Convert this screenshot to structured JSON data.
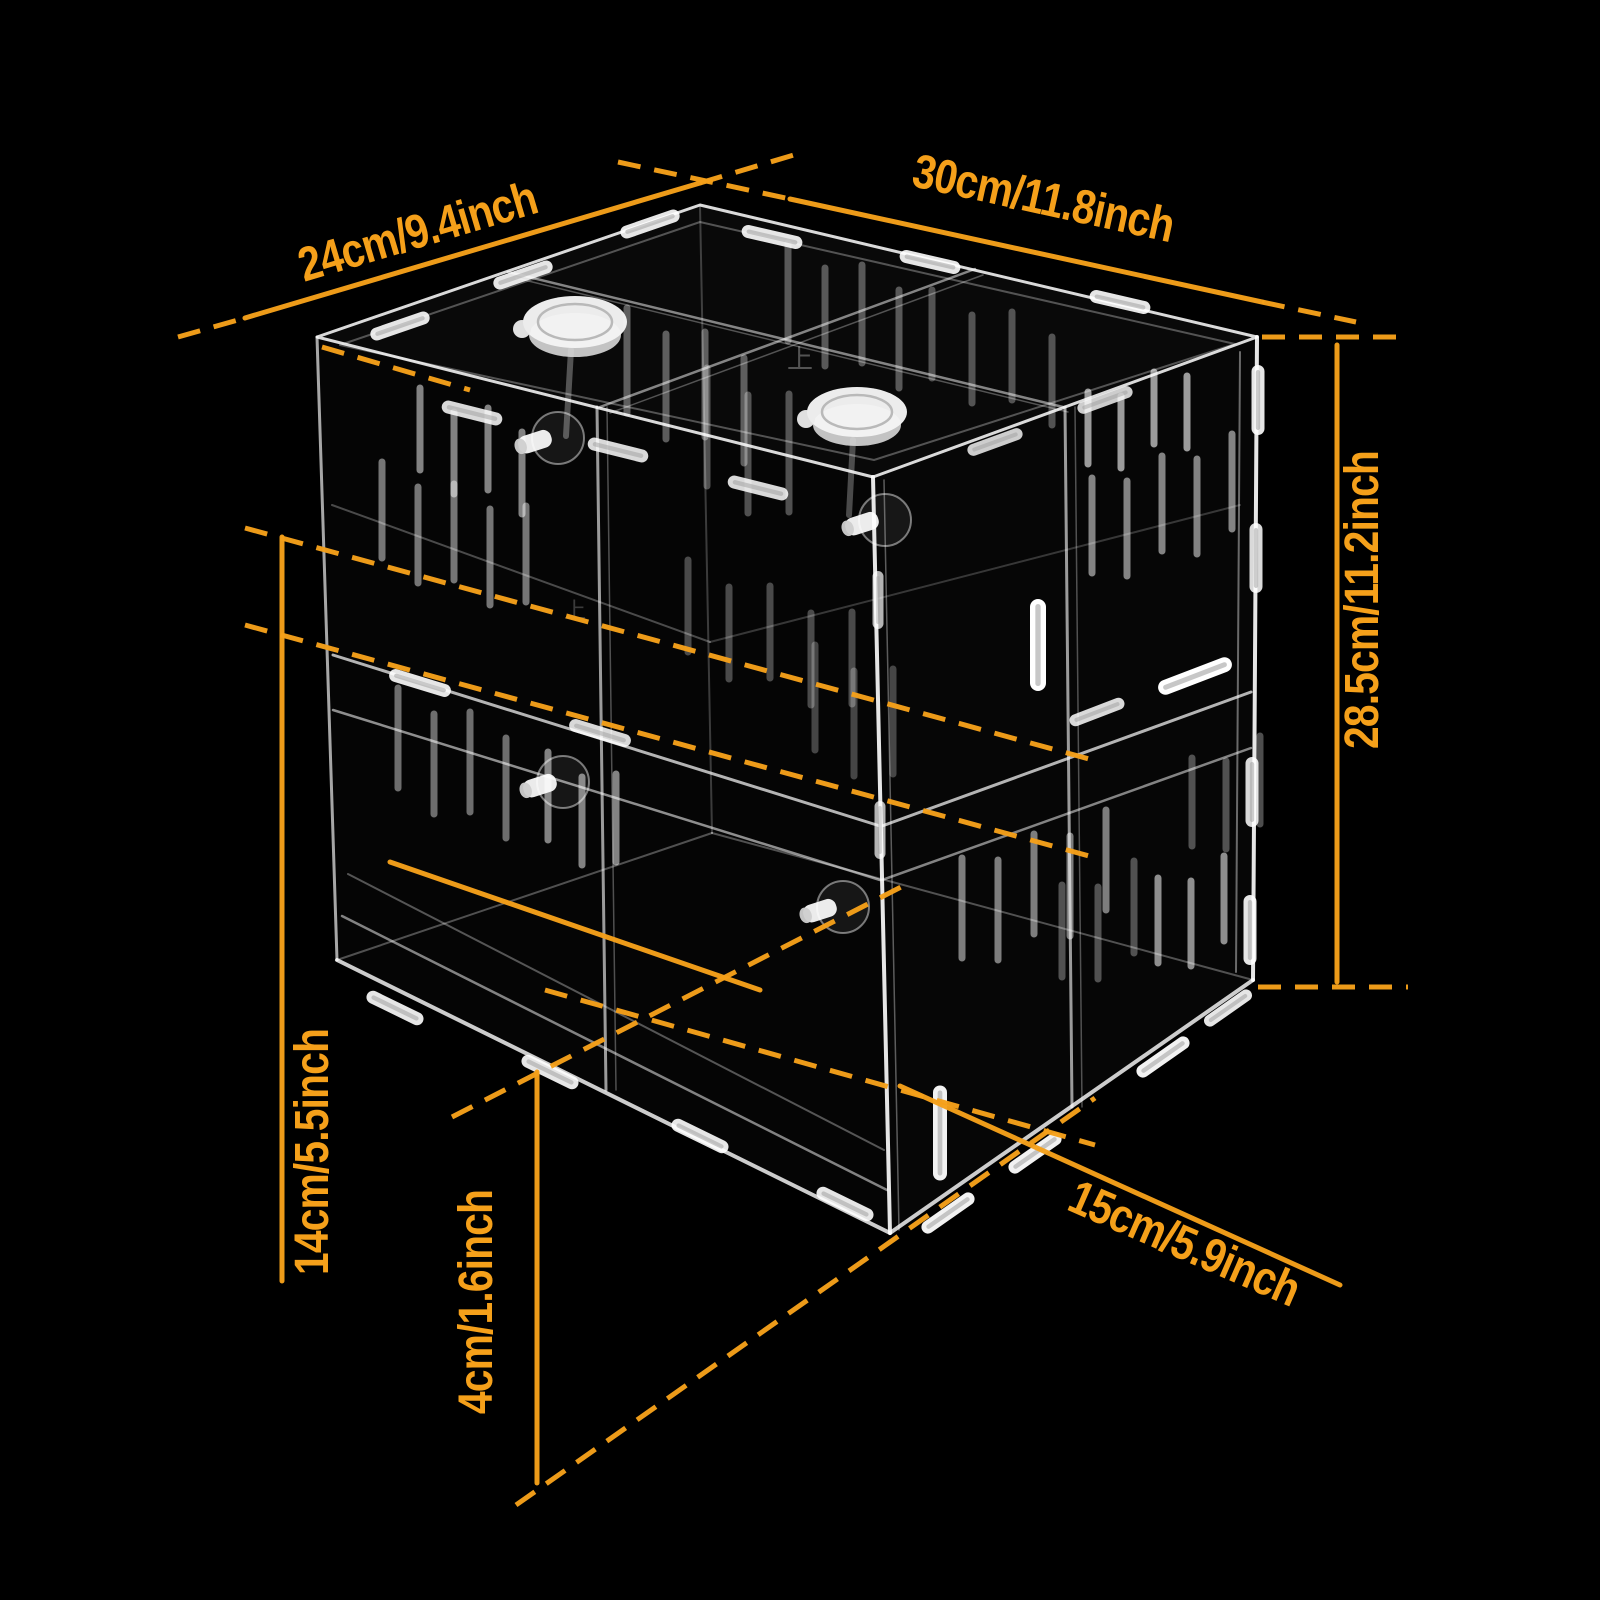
{
  "canvas": {
    "width": 1600,
    "height": 1600,
    "background": "#000000"
  },
  "colors": {
    "accent": "#F5A01A",
    "wire": "#FFFFFF"
  },
  "labels": {
    "depth": {
      "text": "24cm/9.4inch"
    },
    "width": {
      "text": "30cm/11.8inch"
    },
    "height": {
      "text": "28.5cm/11.2inch"
    },
    "compartment_height": {
      "text": "14cm/5.5inch"
    },
    "tray_height": {
      "text": "4cm/1.6inch"
    },
    "compartment_width": {
      "text": "15cm/5.9inch"
    }
  },
  "dimensions": [
    {
      "id": "depth",
      "bind": "labels.depth.text",
      "x": 422,
      "y": 247,
      "angle": -16.5,
      "fontSize": 48,
      "solid": [
        245,
        318,
        700,
        183
      ],
      "dashes": [
        [
          178,
          337,
          245,
          318
        ],
        [
          700,
          183,
          797,
          154
        ]
      ]
    },
    {
      "id": "width",
      "bind": "labels.width.text",
      "x": 1040,
      "y": 214,
      "angle": 12.3,
      "fontSize": 48,
      "solid": [
        790,
        199,
        1262,
        302
      ],
      "dashes": [
        [
          618,
          162,
          790,
          199
        ],
        [
          1262,
          302,
          1356,
          322
        ]
      ]
    },
    {
      "id": "height",
      "bind": "labels.height.text",
      "x": 1378,
      "y": 600,
      "angle": -90,
      "fontSize": 48,
      "solid": [
        1337,
        345,
        1337,
        982
      ],
      "dashes": [
        [
          1262,
          337,
          1408,
          337
        ],
        [
          1258,
          987,
          1408,
          987
        ]
      ]
    },
    {
      "id": "compartment_height",
      "bind": "labels.compartment_height.text",
      "x": 328,
      "y": 1152,
      "angle": -90,
      "fontSize": 48,
      "solid": [
        282,
        537,
        282,
        1281
      ],
      "dashes": []
    },
    {
      "id": "tray_height",
      "bind": "labels.tray_height.text",
      "x": 492,
      "y": 1302,
      "angle": -90,
      "fontSize": 48,
      "solid": [
        537,
        1072,
        537,
        1483
      ],
      "dashes": []
    },
    {
      "id": "compartment_width",
      "bind": "labels.compartment_width.text",
      "x": 1178,
      "y": 1258,
      "angle": 23.5,
      "fontSize": 48,
      "solid": [
        900,
        1086,
        1340,
        1285
      ],
      "dashes": []
    }
  ],
  "figure": {
    "aux_solid_lines": [
      [
        390,
        862,
        760,
        990
      ]
    ],
    "aux_dashed_lines": [
      [
        245,
        528,
        1100,
        762
      ],
      [
        245,
        625,
        1100,
        859
      ],
      [
        452,
        1117,
        903,
        886
      ],
      [
        516,
        1505,
        1095,
        1098
      ],
      [
        545,
        990,
        1095,
        1145
      ],
      [
        322,
        347,
        470,
        390
      ]
    ],
    "box": {
      "faces": [
        {
          "d": "M317,337 L700,205 L1257,337 L873,477 Z",
          "fill": "rgba(255,255,255,0.035)"
        },
        {
          "d": "M317,337 L873,477 L890,1233 L337,960 Z",
          "fill": "rgba(255,255,255,0.018)"
        },
        {
          "d": "M873,477 L1257,337 L1253,980 L890,1233 Z",
          "fill": "rgba(255,255,255,0.022)"
        }
      ],
      "paths": [
        {
          "d": "M317,337 L700,205 L1257,337 L873,477 Z",
          "w": 3,
          "o": 0.85
        },
        {
          "d": "M340,345 L700,222 L1235,344 L874,460 Z",
          "w": 2,
          "o": 0.3
        }
      ],
      "edges": [
        [
          317,
          337,
          337,
          960,
          3,
          0.65
        ],
        [
          873,
          477,
          890,
          1233,
          4,
          0.9
        ],
        [
          884,
          480,
          899,
          1230,
          1.5,
          0.35
        ],
        [
          1257,
          337,
          1253,
          980,
          4,
          0.9
        ],
        [
          1240,
          352,
          1236,
          972,
          2,
          0.4
        ],
        [
          337,
          960,
          890,
          1233,
          4,
          0.8
        ],
        [
          890,
          1233,
          1253,
          980,
          4,
          0.8
        ],
        [
          342,
          916,
          887,
          1190,
          2.5,
          0.5
        ],
        [
          348,
          874,
          884,
          1150,
          2,
          0.32
        ],
        [
          337,
          960,
          712,
          833,
          2,
          0.3
        ],
        [
          712,
          833,
          1253,
          980,
          2,
          0.3
        ],
        [
          700,
          205,
          712,
          833,
          2,
          0.22
        ],
        [
          333,
          655,
          880,
          826,
          3,
          0.7
        ],
        [
          333,
          710,
          880,
          880,
          2.5,
          0.55
        ],
        [
          882,
          826,
          1251,
          692,
          3,
          0.7
        ],
        [
          882,
          880,
          1251,
          748,
          2.5,
          0.5
        ],
        [
          597,
          407,
          606,
          1090,
          3,
          0.6
        ],
        [
          607,
          407,
          616,
          1090,
          1.5,
          0.3
        ],
        [
          1065,
          407,
          1072,
          1107,
          3,
          0.6
        ],
        [
          1075,
          407,
          1082,
          1107,
          1.5,
          0.3
        ],
        [
          508,
          272,
          1063,
          407,
          2.5,
          0.5
        ],
        [
          516,
          278,
          1068,
          412,
          1.5,
          0.3
        ],
        [
          975,
          269,
          600,
          407,
          2.5,
          0.5
        ],
        [
          983,
          275,
          610,
          413,
          1.5,
          0.3
        ],
        [
          332,
          505,
          710,
          642,
          2,
          0.28
        ],
        [
          710,
          642,
          1240,
          505,
          2,
          0.2
        ],
        [
          571,
          350,
          566,
          436,
          6,
          0.3
        ],
        [
          853,
          440,
          849,
          515,
          6,
          0.28
        ]
      ]
    },
    "slit_groups": [
      {
        "x": 420,
        "y": 388,
        "count": 4,
        "dx": 34,
        "dy": 10,
        "len": 82,
        "o": 0.5
      },
      {
        "x": 382,
        "y": 462,
        "count": 5,
        "dx": 36,
        "dy": 11,
        "len": 96,
        "o": 0.45
      },
      {
        "x": 398,
        "y": 688,
        "count": 4,
        "dx": 36,
        "dy": 12,
        "len": 100,
        "o": 0.42
      },
      {
        "x": 548,
        "y": 752,
        "count": 3,
        "dx": 34,
        "dy": 11,
        "len": 88,
        "o": 0.5
      },
      {
        "x": 1088,
        "y": 392,
        "count": 4,
        "dx": 33,
        "dy": -10,
        "len": 72,
        "o": 0.6
      },
      {
        "x": 1092,
        "y": 478,
        "count": 5,
        "dx": 35,
        "dy": -11,
        "len": 95,
        "o": 0.5
      },
      {
        "x": 962,
        "y": 858,
        "count": 5,
        "dx": 36,
        "dy": -12,
        "len": 100,
        "o": 0.48
      },
      {
        "x": 1158,
        "y": 878,
        "count": 3,
        "dx": 33,
        "dy": -11,
        "len": 85,
        "o": 0.55
      },
      {
        "x": 627,
        "y": 308,
        "count": 4,
        "dx": 39,
        "dy": 12,
        "len": 105,
        "o": 0.35
      },
      {
        "x": 707,
        "y": 368,
        "count": 3,
        "dx": 41,
        "dy": 13,
        "len": 118,
        "o": 0.3
      },
      {
        "x": 788,
        "y": 243,
        "count": 4,
        "dx": 37,
        "dy": 11,
        "len": 98,
        "o": 0.32
      },
      {
        "x": 932,
        "y": 290,
        "count": 4,
        "dx": 40,
        "dy": 11,
        "len": 88,
        "o": 0.3
      },
      {
        "x": 688,
        "y": 560,
        "count": 5,
        "dx": 41,
        "dy": 13,
        "len": 92,
        "o": 0.28
      },
      {
        "x": 815,
        "y": 645,
        "count": 3,
        "dx": 39,
        "dy": 12,
        "len": 105,
        "o": 0.26
      },
      {
        "x": 1192,
        "y": 758,
        "count": 3,
        "dx": 34,
        "dy": -11,
        "len": 88,
        "o": 0.3
      },
      {
        "x": 1062,
        "y": 885,
        "count": 3,
        "dx": 36,
        "dy": -12,
        "len": 92,
        "o": 0.3
      }
    ],
    "clips": [
      [
        400,
        326,
        -19,
        62,
        13,
        0.9
      ],
      [
        523,
        275,
        -19,
        62,
        13,
        0.9
      ],
      [
        650,
        224,
        -19,
        62,
        13,
        0.9
      ],
      [
        772,
        237,
        13,
        62,
        13,
        0.9
      ],
      [
        930,
        262,
        13,
        62,
        13,
        0.9
      ],
      [
        1120,
        302,
        13,
        62,
        13,
        0.9
      ],
      [
        472,
        413,
        14,
        62,
        13,
        0.85
      ],
      [
        618,
        450,
        14,
        62,
        13,
        0.85
      ],
      [
        758,
        488,
        14,
        62,
        13,
        0.85
      ],
      [
        995,
        442,
        -20,
        58,
        12,
        0.8
      ],
      [
        1105,
        400,
        -20,
        58,
        12,
        0.8
      ],
      [
        948,
        1213,
        -35,
        62,
        13,
        0.95
      ],
      [
        1035,
        1153,
        -35,
        62,
        13,
        0.95
      ],
      [
        1163,
        1057,
        -35,
        62,
        13,
        0.95
      ],
      [
        1228,
        1008,
        -35,
        56,
        12,
        0.9
      ],
      [
        395,
        1008,
        26,
        62,
        13,
        0.9
      ],
      [
        550,
        1072,
        26,
        62,
        13,
        0.9
      ],
      [
        700,
        1136,
        26,
        62,
        13,
        0.9
      ],
      [
        845,
        1204,
        26,
        62,
        13,
        0.9
      ],
      [
        1258,
        400,
        90,
        70,
        13,
        0.9
      ],
      [
        1256,
        558,
        90,
        70,
        13,
        0.85
      ],
      [
        1252,
        792,
        90,
        70,
        13,
        0.85
      ],
      [
        1250,
        930,
        90,
        70,
        13,
        0.9
      ],
      [
        878,
        600,
        90,
        58,
        11,
        0.7
      ],
      [
        880,
        830,
        90,
        58,
        11,
        0.7
      ],
      [
        1038,
        645,
        90,
        92,
        16,
        1.0
      ],
      [
        940,
        1133,
        90,
        95,
        14,
        0.95
      ],
      [
        420,
        683,
        17,
        64,
        13,
        0.9
      ],
      [
        600,
        733,
        17,
        64,
        13,
        0.85
      ],
      [
        1195,
        676,
        -21,
        78,
        15,
        1.0
      ],
      [
        1097,
        712,
        -21,
        58,
        12,
        0.85
      ]
    ],
    "caps": [
      {
        "cx": 575,
        "cy": 322,
        "rx": 52,
        "ry": 26
      },
      {
        "cx": 857,
        "cy": 412,
        "rx": 50,
        "ry": 25
      }
    ],
    "knobs": [
      {
        "x": 558,
        "y": 438
      },
      {
        "x": 885,
        "y": 520
      },
      {
        "x": 563,
        "y": 782
      },
      {
        "x": 843,
        "y": 907
      }
    ],
    "etched_marks": [
      {
        "text": "上",
        "x": 800,
        "y": 368,
        "size": 26,
        "o": 0.3
      },
      {
        "text": "上",
        "x": 575,
        "y": 618,
        "size": 22,
        "o": 0.22
      }
    ]
  }
}
